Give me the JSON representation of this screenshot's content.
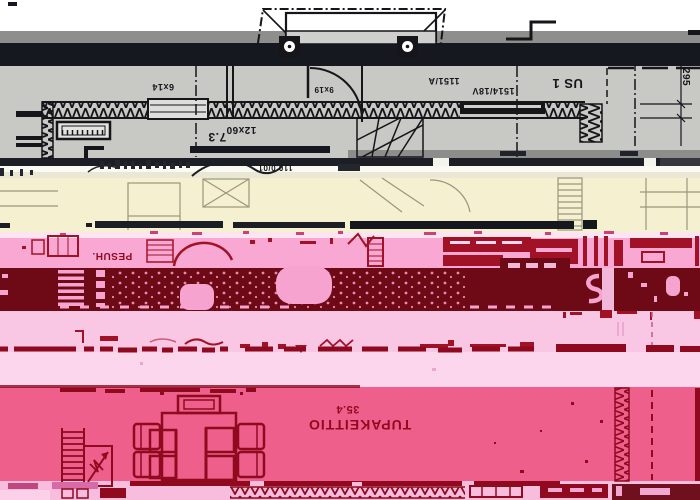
{
  "scene": {
    "kind": "corrupted-floorplan-scan",
    "description": "Glitched, color-banded scan of an upside-down Finnish architectural floor plan"
  },
  "plan_labels": {
    "room_main": "TUPAKEITTIO",
    "room_main_area": "35.4",
    "room_pesuh": "PESUH.",
    "wall_type": "US 1",
    "window_code_a": "1514/18V",
    "window_code_b": "1151/A",
    "area_small": "7.3",
    "dim_right": "295",
    "door_code": "9x19",
    "lintel_code": "12x60",
    "lintel_code_b": "6x14",
    "elevation_mark": "110.0/01"
  },
  "band_colors": {
    "white_margin": "#ffffff",
    "gray_strip": "#8e8e8c",
    "black_strip": "#15181f",
    "plan_gray": "#c8c8c5",
    "cream": "#f5f0d0",
    "pink_upper": "#f8a8d2",
    "maroon": "#6e0a16",
    "pink_mid": "#f9c6e4",
    "pink_pale": "#fbd6ec",
    "rose": "#ef5f8c",
    "bottom_strip": "#f8bcdc",
    "ink_gray": "#15151a",
    "ink_red": "#8f0a1e"
  }
}
